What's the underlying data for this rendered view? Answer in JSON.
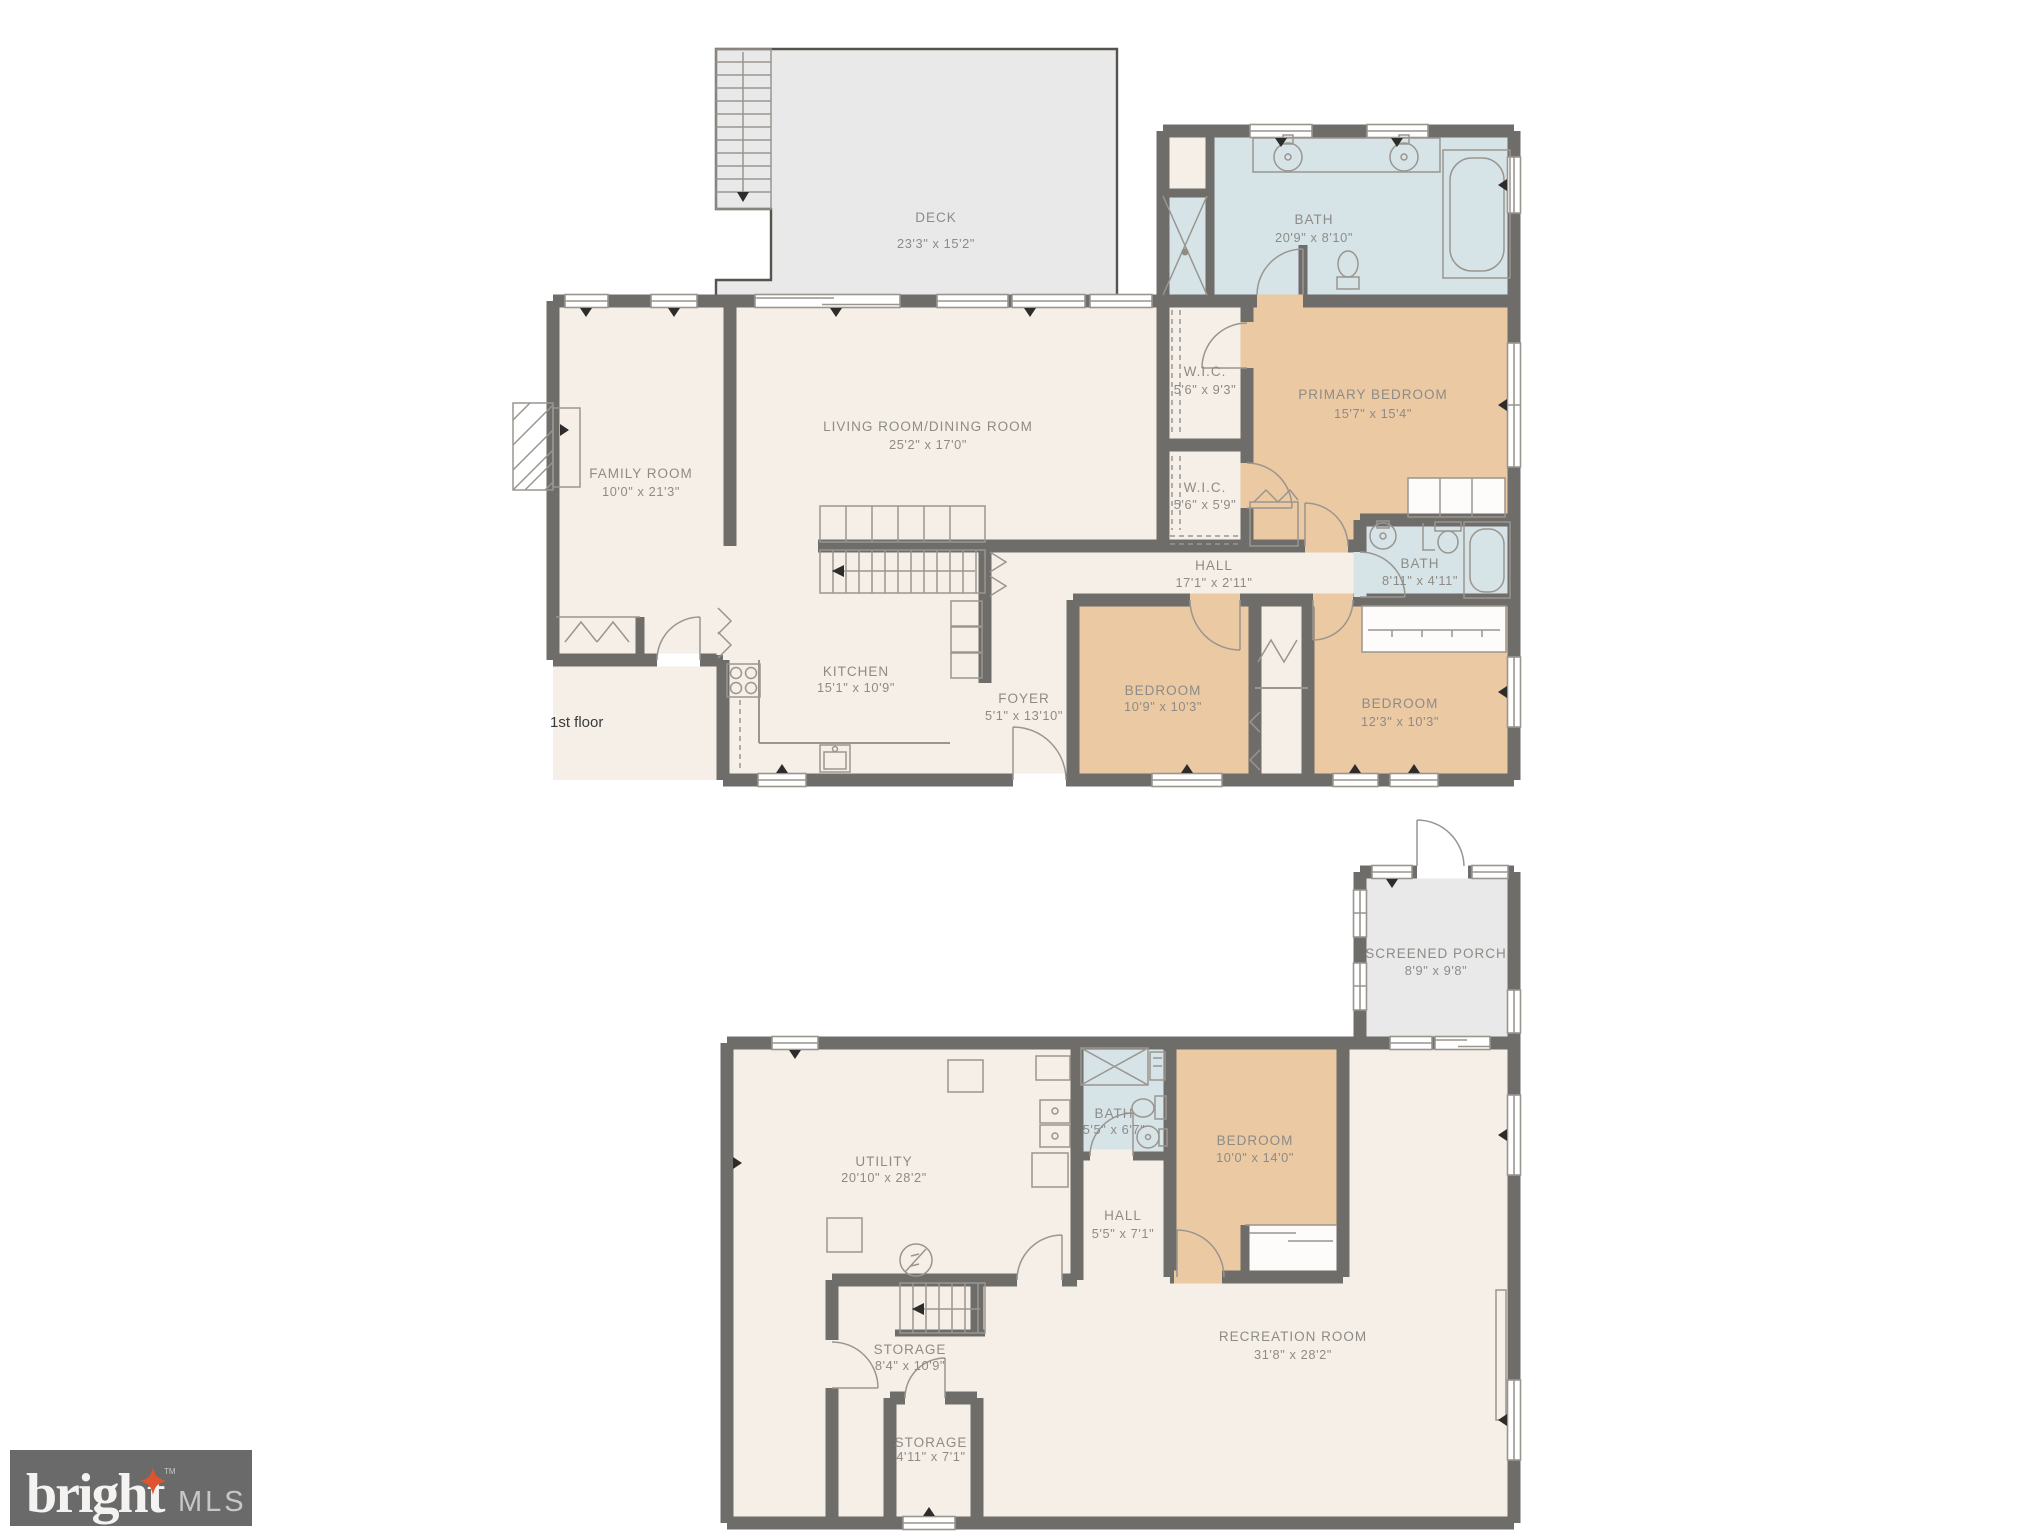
{
  "floor1": {
    "caption": "1st floor",
    "deck": {
      "name": "DECK",
      "dims": "23'3\" x 15'2\""
    },
    "primary_bath": {
      "name": "BATH",
      "dims": "20'9\" x 8'10\""
    },
    "wic_upper": {
      "name": "W.I.C.",
      "dims": "5'6\" x 9'3\""
    },
    "wic_lower": {
      "name": "W.I.C.",
      "dims": "5'6\" x 5'9\""
    },
    "primary_bedroom": {
      "name": "PRIMARY BEDROOM",
      "dims": "15'7\" x 15'4\""
    },
    "family_room": {
      "name": "FAMILY ROOM",
      "dims": "10'0\" x 21'3\""
    },
    "living_dining": {
      "name": "LIVING ROOM/DINING ROOM",
      "dims": "25'2\" x 17'0\""
    },
    "hall": {
      "name": "HALL",
      "dims": "17'1\" x 2'11\""
    },
    "hall_bath": {
      "name": "BATH",
      "dims": "8'11\" x 4'11\""
    },
    "kitchen": {
      "name": "KITCHEN",
      "dims": "15'1\" x 10'9\""
    },
    "foyer": {
      "name": "FOYER",
      "dims": "5'1\" x 13'10\""
    },
    "bedroom_left": {
      "name": "BEDROOM",
      "dims": "10'9\" x 10'3\""
    },
    "bedroom_right": {
      "name": "BEDROOM",
      "dims": "12'3\" x 10'3\""
    }
  },
  "floor2": {
    "screened_porch": {
      "name": "SCREENED PORCH",
      "dims": "8'9\" x 9'8\""
    },
    "utility": {
      "name": "UTILITY",
      "dims": "20'10\" x 28'2\""
    },
    "bath": {
      "name": "BATH",
      "dims": "5'5\" x 6'7\""
    },
    "bedroom": {
      "name": "BEDROOM",
      "dims": "10'0\" x 14'0\""
    },
    "hall": {
      "name": "HALL",
      "dims": "5'5\" x 7'1\""
    },
    "recreation": {
      "name": "RECREATION ROOM",
      "dims": "31'8\" x 28'2\""
    },
    "storage_upper": {
      "name": "STORAGE",
      "dims": "8'4\" x 10'9\""
    },
    "storage_lower": {
      "name": "STORAGE",
      "dims": "4'11\" x 7'1\""
    }
  },
  "logo": {
    "brand": "bright",
    "suffix": "MLS",
    "tm": "TM"
  },
  "colors": {
    "wall": "#6f6d6a",
    "line": "#9a958f",
    "cream": "#f6efe7",
    "tan": "#ebc9a3",
    "blue": "#d6e4e8",
    "gray": "#e9e9e9",
    "label": "#8e8b87",
    "text": "#3a3a3a",
    "logo_bg": "#6a6a6a",
    "logo_star": "#e0532e"
  }
}
